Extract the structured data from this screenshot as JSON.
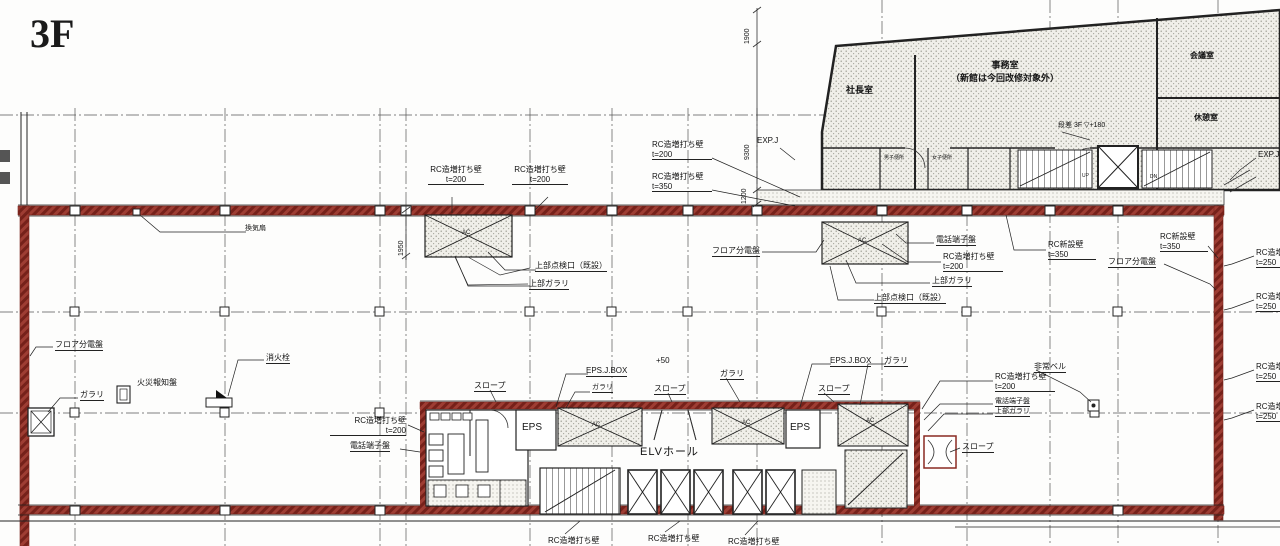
{
  "title": "3F",
  "colors": {
    "wall_red": "#8a2a22",
    "line": "#1c1c1c",
    "hatch_bg": "#f0efe9"
  },
  "labels": {
    "rc_add_t200": "RC造増打ち壁\nt=200",
    "rc_add_t350": "RC造増打ち壁\nt=350",
    "rc_add_t250": "RC造増打ち壁\nt=250",
    "rc_add": "RC造増打ち壁",
    "rc_new_t350": "RC新設壁\nt=350",
    "upper_access_hatch": "上部点検口（既設）",
    "upper_louver": "上部ガラリ",
    "floor_panel": "フロア分電盤",
    "phone_panel": "電話端子盤",
    "fire_alarm_panel": "火災報知盤",
    "fire_hydrant": "消火栓",
    "vent_fan": "換気扇",
    "louver": "ガラリ",
    "slope": "スロープ",
    "eps_jbox": "EPS.J.BOX",
    "eps": "EPS",
    "elv_hall": "ELVホール",
    "plus50": "+50",
    "emergency_bell": "非常ベル",
    "exp_joint": "EXP.J",
    "ac_unit": "AC",
    "up": "UP",
    "dn": "DN"
  },
  "rooms": {
    "president_office": "社長室",
    "office": "事務室\n（新館は今回改修対象外）",
    "meeting_room": "会議室",
    "rest_room": "休憩室",
    "mens_toilet": "男子便所",
    "womens_toilet": "女子便所",
    "step_note": "段差 3F ▽+180"
  },
  "dimensions": {
    "d1900": "1900",
    "d9300": "9300",
    "d1200": "1200",
    "d1950": "1950"
  }
}
